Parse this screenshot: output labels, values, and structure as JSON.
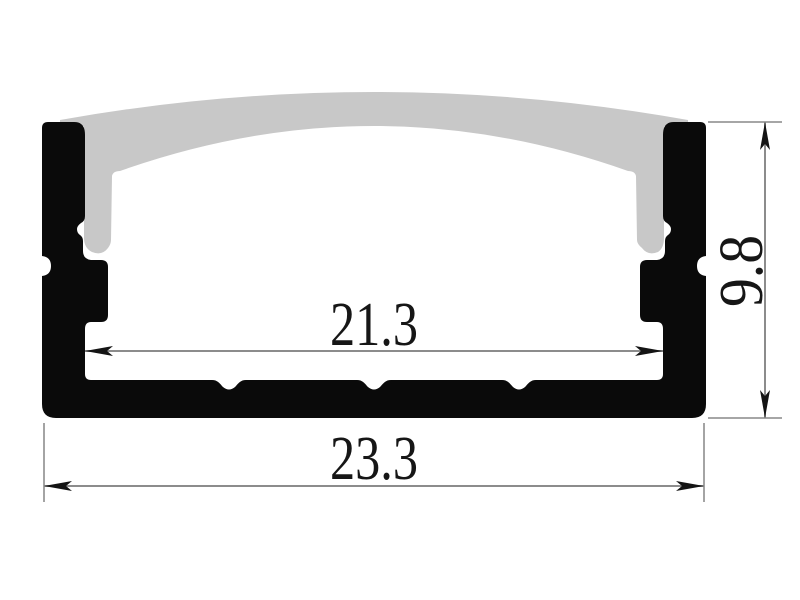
{
  "drawing": {
    "title": "LED aluminium profile cross-section",
    "dimensions": {
      "inner_width": {
        "value": "21.3"
      },
      "overall_width": {
        "value": "23.3"
      },
      "height": {
        "value": "9.8"
      }
    },
    "colors": {
      "profile": "#0a0a0a",
      "diffuser": "#c8c8c8",
      "dim_line": "#8c8c8c",
      "arrow": "#141414",
      "text": "#161616",
      "background": "#ffffff"
    }
  }
}
